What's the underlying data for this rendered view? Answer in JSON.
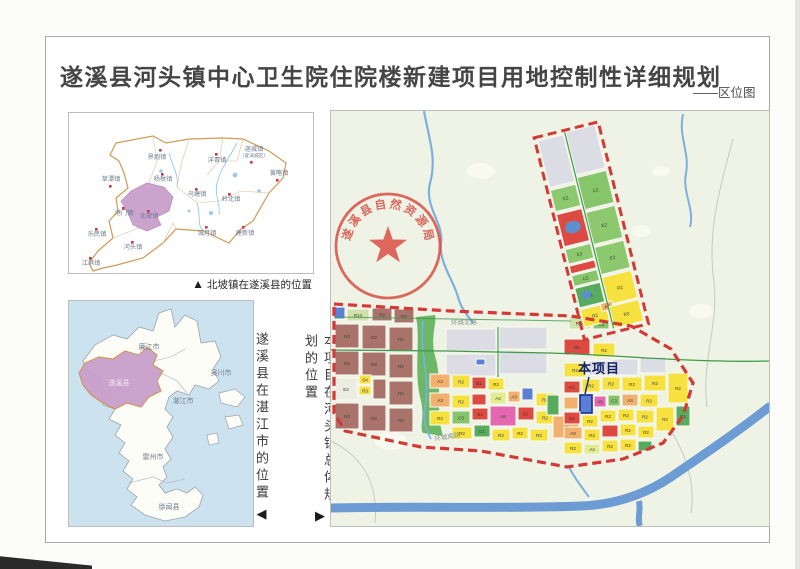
{
  "page": {
    "title": "遂溪县河头镇中心卫生院住院楼新建项目用地控制性详细规划",
    "subtitle": "——区位图"
  },
  "county_map": {
    "caption_marker": "▲",
    "caption": "北坡镇在遂溪县的位置",
    "towns": [
      {
        "n": "界炮镇",
        "x": 88,
        "y": 46,
        "dx": 90,
        "dy": 36
      },
      {
        "n": "遂城镇",
        "sub": "（遂溪城区）",
        "x": 185,
        "y": 38,
        "dx": 181,
        "dy": 48
      },
      {
        "n": "洋青镇",
        "x": 148,
        "y": 49,
        "dx": 146,
        "dy": 40
      },
      {
        "n": "黄略镇",
        "x": 210,
        "y": 62,
        "dx": 207,
        "dy": 66
      },
      {
        "n": "草潭镇",
        "x": 42,
        "y": 68,
        "dx": 40,
        "dy": 72
      },
      {
        "n": "杨柑镇",
        "x": 94,
        "y": 68,
        "dx": 92,
        "dy": 60
      },
      {
        "n": "乌塘镇",
        "x": 128,
        "y": 83,
        "dx": 126,
        "dy": 75
      },
      {
        "n": "岭北镇",
        "x": 162,
        "y": 88,
        "dx": 159,
        "dy": 80
      },
      {
        "n": "港门镇",
        "x": 55,
        "y": 102,
        "dx": 53,
        "dy": 94
      },
      {
        "n": "北坡镇",
        "x": 80,
        "y": 105,
        "dx": 78,
        "dy": 97
      },
      {
        "n": "城月镇",
        "x": 138,
        "y": 122,
        "dx": 136,
        "dy": 113
      },
      {
        "n": "建新镇",
        "x": 176,
        "y": 122,
        "dx": 173,
        "dy": 113
      },
      {
        "n": "乐民镇",
        "x": 28,
        "y": 123,
        "dx": 26,
        "dy": 115
      },
      {
        "n": "河头镇",
        "x": 64,
        "y": 136,
        "dx": 62,
        "dy": 128
      },
      {
        "n": "江洪镇",
        "x": 22,
        "y": 152,
        "dx": 20,
        "dy": 144
      }
    ]
  },
  "city_map": {
    "caption": "遂溪县在湛江市的位置",
    "caption_marker": "◀",
    "regions": [
      {
        "n": "廉江市",
        "x": 80,
        "y": 48
      },
      {
        "n": "吴川市",
        "x": 152,
        "y": 74
      },
      {
        "n": "遂溪县",
        "x": 50,
        "y": 84,
        "light": true
      },
      {
        "n": "湛江市",
        "x": 114,
        "y": 102
      },
      {
        "n": "雷州市",
        "x": 84,
        "y": 158
      },
      {
        "n": "徐闻县",
        "x": 100,
        "y": 208
      }
    ]
  },
  "divider": {
    "caption": "本项目在河头镇总体规划的位置",
    "caption_marker": "▶"
  },
  "main_map": {
    "seal_text": "遂溪县自然资源局",
    "project_label": "本项目",
    "road_labels": [
      {
        "text": "环城北路"
      },
      {
        "text": "环城南路"
      }
    ],
    "parcels": [
      [
        3,
        196,
        11,
        12,
        "blu",
        ""
      ],
      [
        16,
        198,
        22,
        12,
        "R14",
        "R14"
      ],
      [
        41,
        197,
        20,
        13,
        "R2b",
        "R2"
      ],
      [
        63,
        198,
        20,
        14,
        "R2b",
        "R2"
      ],
      [
        4,
        213,
        24,
        24,
        "R2b",
        "R2"
      ],
      [
        31,
        214,
        24,
        24,
        "R2b",
        "R2"
      ],
      [
        58,
        216,
        24,
        24,
        "R2b",
        "R2"
      ],
      [
        4,
        240,
        24,
        24,
        "R2b",
        "R2"
      ],
      [
        31,
        241,
        24,
        24,
        "R2b",
        "R2"
      ],
      [
        58,
        243,
        24,
        24,
        "R2b",
        "R2"
      ],
      [
        4,
        267,
        22,
        22,
        "pal",
        "E2"
      ],
      [
        28,
        264,
        12,
        9,
        "S4",
        "S4"
      ],
      [
        28,
        275,
        12,
        9,
        "R2y",
        "R3"
      ],
      [
        42,
        268,
        13,
        20,
        "R2b",
        ""
      ],
      [
        58,
        270,
        24,
        24,
        "R2b",
        "R2"
      ],
      [
        4,
        292,
        24,
        26,
        "R2b",
        "R2"
      ],
      [
        31,
        294,
        24,
        26,
        "R2b",
        "R2"
      ],
      [
        58,
        297,
        24,
        24,
        "R2b",
        "R2"
      ],
      [
        115,
        218,
        50,
        22,
        "gry",
        ""
      ],
      [
        168,
        216,
        48,
        22,
        "gry",
        ""
      ],
      [
        115,
        243,
        50,
        22,
        "gry",
        ""
      ],
      [
        168,
        241,
        48,
        22,
        "gry",
        ""
      ],
      [
        145,
        248,
        9,
        6,
        "blu",
        ""
      ],
      [
        233,
        228,
        26,
        16,
        "B1",
        "B1"
      ],
      [
        262,
        232,
        22,
        14,
        "R2y",
        "R2"
      ],
      [
        238,
        206,
        22,
        12,
        "R14",
        "R14"
      ],
      [
        262,
        208,
        16,
        10,
        "C2",
        "C3"
      ],
      [
        99,
        263,
        20,
        14,
        "A3",
        "A3"
      ],
      [
        121,
        264,
        18,
        13,
        "R2y",
        "R2"
      ],
      [
        141,
        266,
        14,
        12,
        "B1",
        "B1"
      ],
      [
        157,
        267,
        16,
        12,
        "R2y",
        "R2"
      ],
      [
        99,
        282,
        20,
        14,
        "A3",
        "A3"
      ],
      [
        121,
        284,
        18,
        13,
        "R2y",
        "R2"
      ],
      [
        141,
        283,
        14,
        11,
        "B1",
        ""
      ],
      [
        99,
        300,
        20,
        14,
        "R2y",
        "R2"
      ],
      [
        121,
        300,
        18,
        13,
        "C2",
        "C3"
      ],
      [
        141,
        297,
        16,
        12,
        "B1",
        "B1"
      ],
      [
        159,
        295,
        26,
        20,
        "A5",
        "A5"
      ],
      [
        187,
        296,
        16,
        13,
        "B1",
        "B1"
      ],
      [
        159,
        281,
        16,
        12,
        "A4",
        "A4"
      ],
      [
        177,
        280,
        12,
        11,
        "A3",
        "A3"
      ],
      [
        191,
        277,
        11,
        12,
        "blu",
        ""
      ],
      [
        205,
        282,
        18,
        13,
        "R2y",
        "R2"
      ],
      [
        121,
        316,
        20,
        12,
        "R2y",
        "R2"
      ],
      [
        143,
        314,
        16,
        12,
        "G1",
        "G1"
      ],
      [
        161,
        318,
        18,
        12,
        "R2y",
        "R2"
      ],
      [
        181,
        316,
        16,
        12,
        "R2y",
        "R2"
      ],
      [
        205,
        300,
        18,
        13,
        "R2y",
        "R2"
      ],
      [
        199,
        318,
        18,
        12,
        "R2y",
        "R2"
      ],
      [
        222,
        305,
        26,
        22,
        "A3",
        "A3"
      ],
      [
        216,
        284,
        12,
        20,
        "G1",
        ""
      ],
      [
        233,
        252,
        22,
        14,
        "R2y",
        "R2"
      ],
      [
        257,
        250,
        22,
        14,
        "gry",
        ""
      ],
      [
        281,
        248,
        26,
        16,
        "gry",
        ""
      ],
      [
        309,
        246,
        26,
        16,
        "gry",
        ""
      ],
      [
        233,
        270,
        16,
        12,
        "R1",
        "R1"
      ],
      [
        251,
        268,
        18,
        13,
        "R2y",
        "R2"
      ],
      [
        271,
        266,
        18,
        13,
        "R2y",
        "R2"
      ],
      [
        291,
        266,
        20,
        14,
        "R2y",
        "R2"
      ],
      [
        313,
        264,
        22,
        16,
        "R2y",
        "R2"
      ],
      [
        337,
        262,
        20,
        30,
        "R2y",
        "R2"
      ],
      [
        233,
        286,
        14,
        12,
        "A3",
        ""
      ],
      [
        249,
        284,
        12,
        18,
        "prj",
        ""
      ],
      [
        263,
        285,
        12,
        11,
        "A5",
        "A5"
      ],
      [
        277,
        284,
        12,
        11,
        "C2",
        "C3"
      ],
      [
        291,
        283,
        16,
        12,
        "A3",
        "A3"
      ],
      [
        309,
        283,
        18,
        13,
        "R2y",
        "R2"
      ],
      [
        233,
        301,
        16,
        12,
        "B1",
        "B1"
      ],
      [
        251,
        304,
        16,
        12,
        "R2y",
        "R2"
      ],
      [
        269,
        299,
        16,
        12,
        "R2y",
        "R2"
      ],
      [
        287,
        298,
        16,
        12,
        "R2y",
        "R2"
      ],
      [
        305,
        299,
        18,
        13,
        "R2y",
        "R2"
      ],
      [
        325,
        296,
        18,
        24,
        "R2y",
        "R2"
      ],
      [
        345,
        295,
        14,
        20,
        "G1",
        "G1"
      ],
      [
        233,
        316,
        18,
        12,
        "A3",
        "A3"
      ],
      [
        253,
        318,
        16,
        12,
        "R2y",
        "R2"
      ],
      [
        271,
        314,
        16,
        12,
        "B1",
        ""
      ],
      [
        289,
        313,
        16,
        12,
        "R2y",
        "R2"
      ],
      [
        307,
        315,
        16,
        12,
        "R2y",
        "R2"
      ],
      [
        233,
        331,
        18,
        12,
        "R2y",
        "R2"
      ],
      [
        253,
        333,
        16,
        10,
        "A4",
        "A4"
      ],
      [
        271,
        329,
        16,
        12,
        "R2y",
        "R2"
      ],
      [
        289,
        328,
        16,
        12,
        "R2y",
        "R2"
      ],
      [
        307,
        330,
        14,
        10,
        "G1",
        ""
      ]
    ],
    "strip_parcels": [
      [
        207,
        30,
        26,
        48,
        "gry",
        ""
      ],
      [
        236,
        28,
        30,
        44,
        "gry",
        ""
      ],
      [
        207,
        81,
        26,
        22,
        "E2",
        "E2"
      ],
      [
        207,
        106,
        26,
        33,
        "R1",
        "R1"
      ],
      [
        207,
        142,
        26,
        15,
        "E2",
        "E2"
      ],
      [
        207,
        159,
        26,
        8,
        "R1",
        ""
      ],
      [
        207,
        169,
        26,
        11,
        "C2",
        "C2"
      ],
      [
        207,
        182,
        26,
        20,
        "G1",
        "G1"
      ],
      [
        207,
        204,
        26,
        18,
        "R2y",
        "R2"
      ],
      [
        236,
        75,
        30,
        33,
        "C2",
        "C2"
      ],
      [
        236,
        111,
        30,
        33,
        "E2",
        "E2"
      ],
      [
        236,
        147,
        30,
        28,
        "E2",
        "E2"
      ],
      [
        236,
        178,
        30,
        28,
        "R2y",
        "R2"
      ],
      [
        228,
        203,
        12,
        8,
        "A3",
        "A3"
      ],
      [
        236,
        208,
        30,
        22,
        "R2y",
        "R2"
      ]
    ]
  },
  "colors": {
    "boundary_red": "#d43a35",
    "seal_red": "#d9453c",
    "river_blue": "#7db0de",
    "big_river_blue": "#6d9bd3",
    "road_green": "#3e9b4b",
    "town_dot": "#c23b4a",
    "map_label": "#6b7b8d",
    "county_outline": "#cf9a55",
    "highlight_purple": "#c9a0cc",
    "zones": {
      "R2b": "#a9736b",
      "R2y": "#f7e13e",
      "R14": "#cfe0a8",
      "E2": "#8cc86d",
      "C2": "#86c56a",
      "G1": "#58ab5e",
      "R1": "#dd4a42",
      "B1": "#dd4a42",
      "A3": "#f2b06e",
      "A4": "#e3ec8e",
      "A5": "#e468b0",
      "S4": "#f7e13e",
      "gry": "#dcdce4",
      "blu": "#5b7fd8",
      "pal": "#ecece0",
      "prj": "#5b7fd8"
    }
  }
}
